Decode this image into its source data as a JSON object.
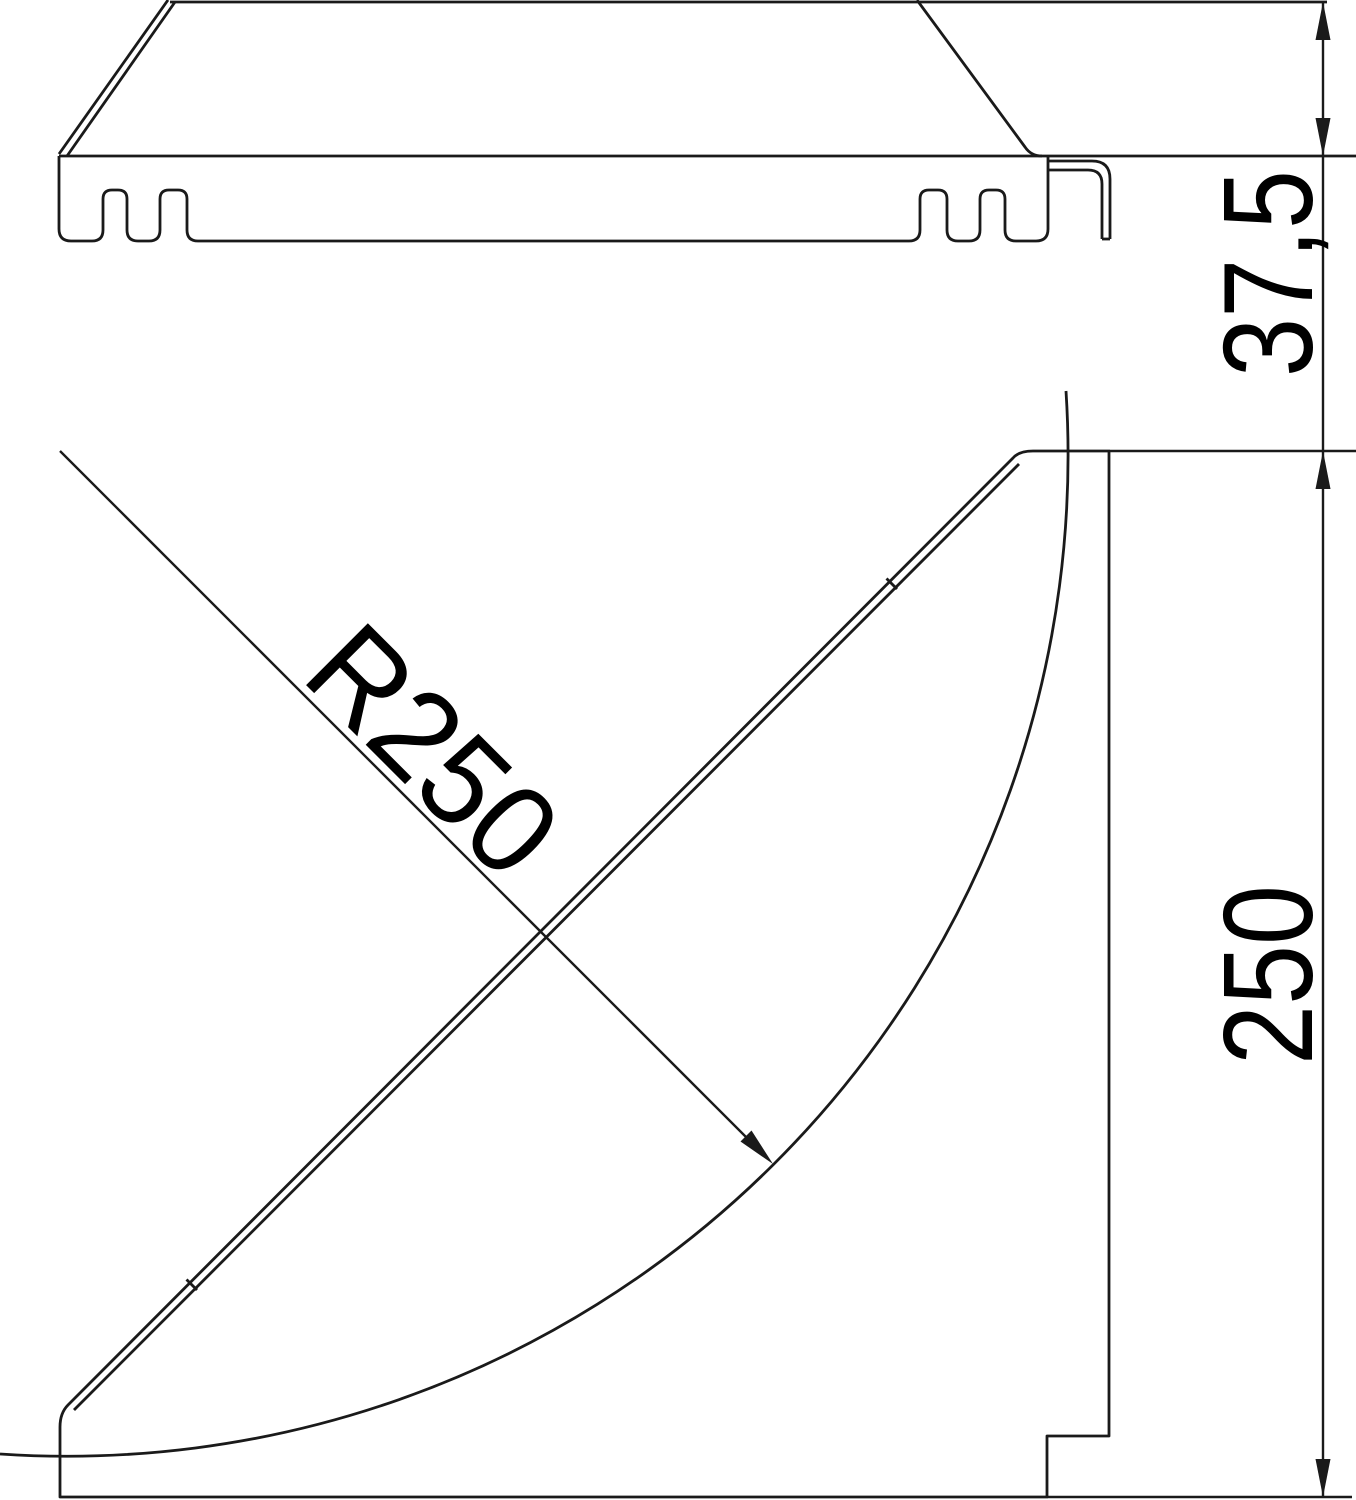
{
  "drawing": {
    "type": "cad-technical-drawing",
    "description": "Two orthographic views of a 90-degree cable-tray bend: side section profile (top) and plan view with quarter-circle inner rail (bottom)",
    "labels": {
      "flange_height": "37,5",
      "bend_radius": "R250",
      "side_length": "250"
    },
    "colors": {
      "line": "#1a1a1a",
      "text": "#000000",
      "background": "#ffffff"
    }
  }
}
